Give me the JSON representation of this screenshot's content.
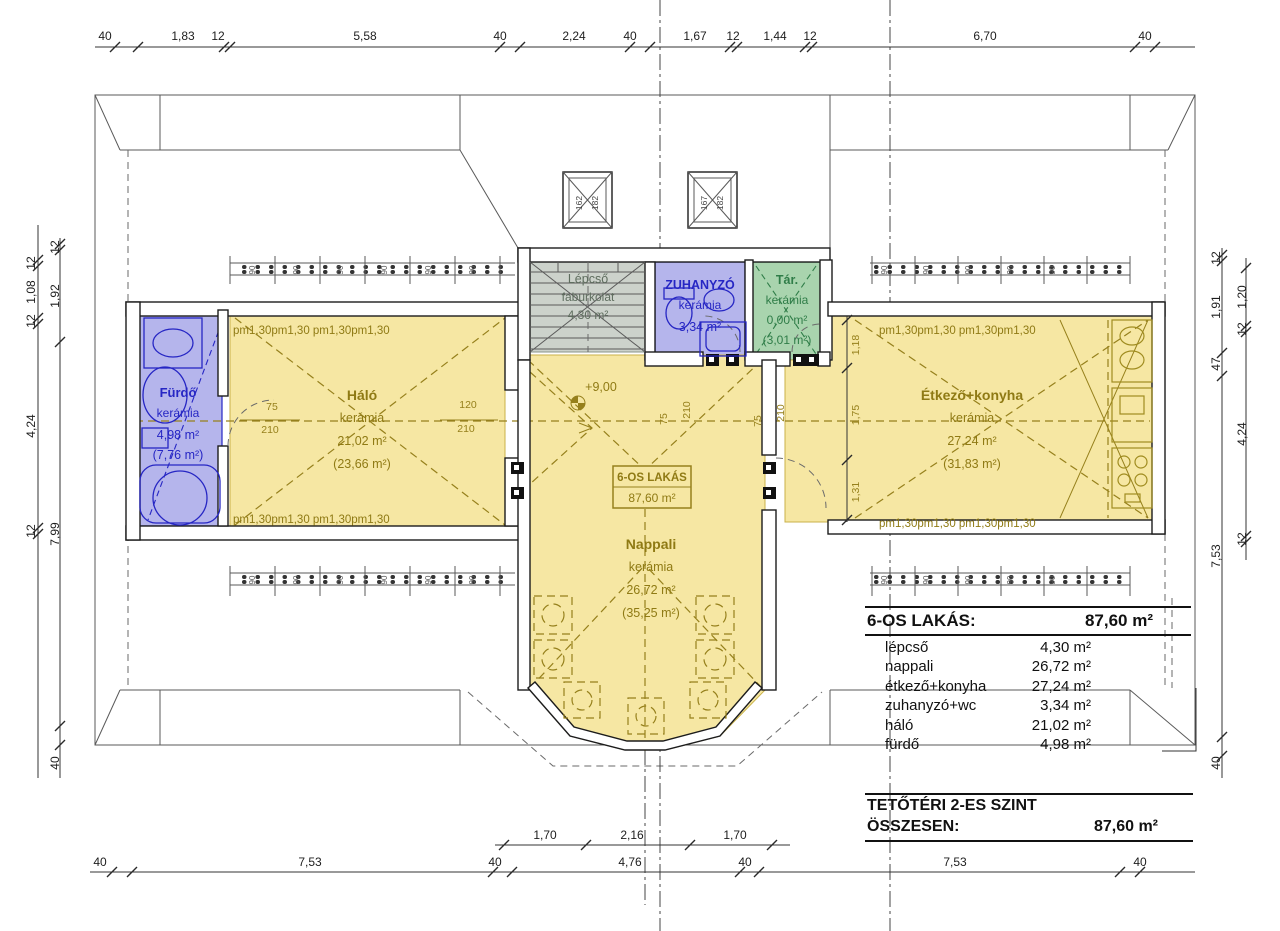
{
  "drawing": {
    "dims": {
      "top": [
        "40",
        "1,83",
        "12",
        "5,58",
        "40",
        "2,24",
        "40",
        "1,67",
        "12",
        "1,44",
        "12",
        "6,70",
        "40"
      ],
      "bottom_outer": [
        "40",
        "7,53",
        "40",
        "4,76",
        "40",
        "7,53",
        "40"
      ],
      "bottom_inner": [
        "1,70",
        "2,16",
        "1,70"
      ],
      "left_inner": [
        "12",
        "1,08",
        "12",
        "4,24",
        "12"
      ],
      "left_outer": [
        "12",
        "1,92",
        "7,99"
      ],
      "left_bottom": "40",
      "right_outer": [
        "12",
        "1,91",
        "47",
        "7,53"
      ],
      "right_inner": [
        "1,20",
        "12",
        "4,24",
        "12"
      ],
      "right_bottom": "40",
      "right_wing_inner": [
        "1,18",
        "1,75",
        "1,31"
      ],
      "door_fur": {
        "w": "75",
        "h": "210"
      },
      "window_halo": {
        "w": "120",
        "h": "210"
      },
      "door_stair": {
        "w": "75",
        "h": "210"
      },
      "door_etkezo": {
        "w": "75",
        "h": "210"
      },
      "window_unit": "90",
      "parapet_run": "pm1,30pm1,30 pm1,30pm1,30",
      "chimney_left": [
        "162",
        "182"
      ],
      "chimney_right": [
        "167",
        "182"
      ]
    },
    "level_mark": "+9,00",
    "rooms": {
      "furdo": {
        "name": "Fürdő",
        "finish": "kerámia",
        "net": "4,98 m²",
        "gross": "(7,76 m²)"
      },
      "halo": {
        "name": "Háló",
        "finish": "kerámia",
        "net": "21,02 m²",
        "gross": "(23,66 m²)"
      },
      "lepcso": {
        "name": "Lépcső",
        "finish": "faburkolat",
        "net": "4,30 m²"
      },
      "zuhanyzo": {
        "name": "ZUHANYZÓ",
        "finish": "kerámia",
        "net": "3,34 m²"
      },
      "tar": {
        "name": "Tár.",
        "finish": "kerámia",
        "net": "0,00 m²",
        "gross": "(3,01 m²)"
      },
      "nappali": {
        "name": "Nappali",
        "finish": "kerámia",
        "net": "26,72 m²",
        "gross": "(35,25 m²)"
      },
      "etkezo": {
        "name": "Étkező+konyha",
        "finish": "kerámia",
        "net": "27,24 m²",
        "gross": "(31,83 m²)"
      }
    },
    "unit_label": {
      "name": "6-OS LAKÁS",
      "area": "87,60 m²"
    },
    "summary": {
      "title": "6-OS LAKÁS:",
      "title_value": "87,60 m²",
      "rows": [
        {
          "label": "lépcső",
          "value": "4,30 m²"
        },
        {
          "label": "nappali",
          "value": "26,72 m²"
        },
        {
          "label": "étkező+konyha",
          "value": "27,24 m²"
        },
        {
          "label": "zuhanyzó+wc",
          "value": "3,34 m²"
        },
        {
          "label": "háló",
          "value": "21,02 m²"
        },
        {
          "label": "fürdő",
          "value": "4,98 m²"
        }
      ],
      "footer_title": "TETŐTÉRI 2-ES SZINT",
      "footer_label": "ÖSSZESEN:",
      "footer_value": "87,60 m²"
    },
    "colors": {
      "room_yellow": "#f6e7a3",
      "room_blue": "#b5b5ec",
      "room_green": "#a9d4ae",
      "room_gray": "#ccd2cb",
      "accent_yellow": "#96801c",
      "accent_blue": "#2626c4",
      "accent_green": "#2f7d48",
      "line_dark": "#1c1c1c"
    }
  }
}
